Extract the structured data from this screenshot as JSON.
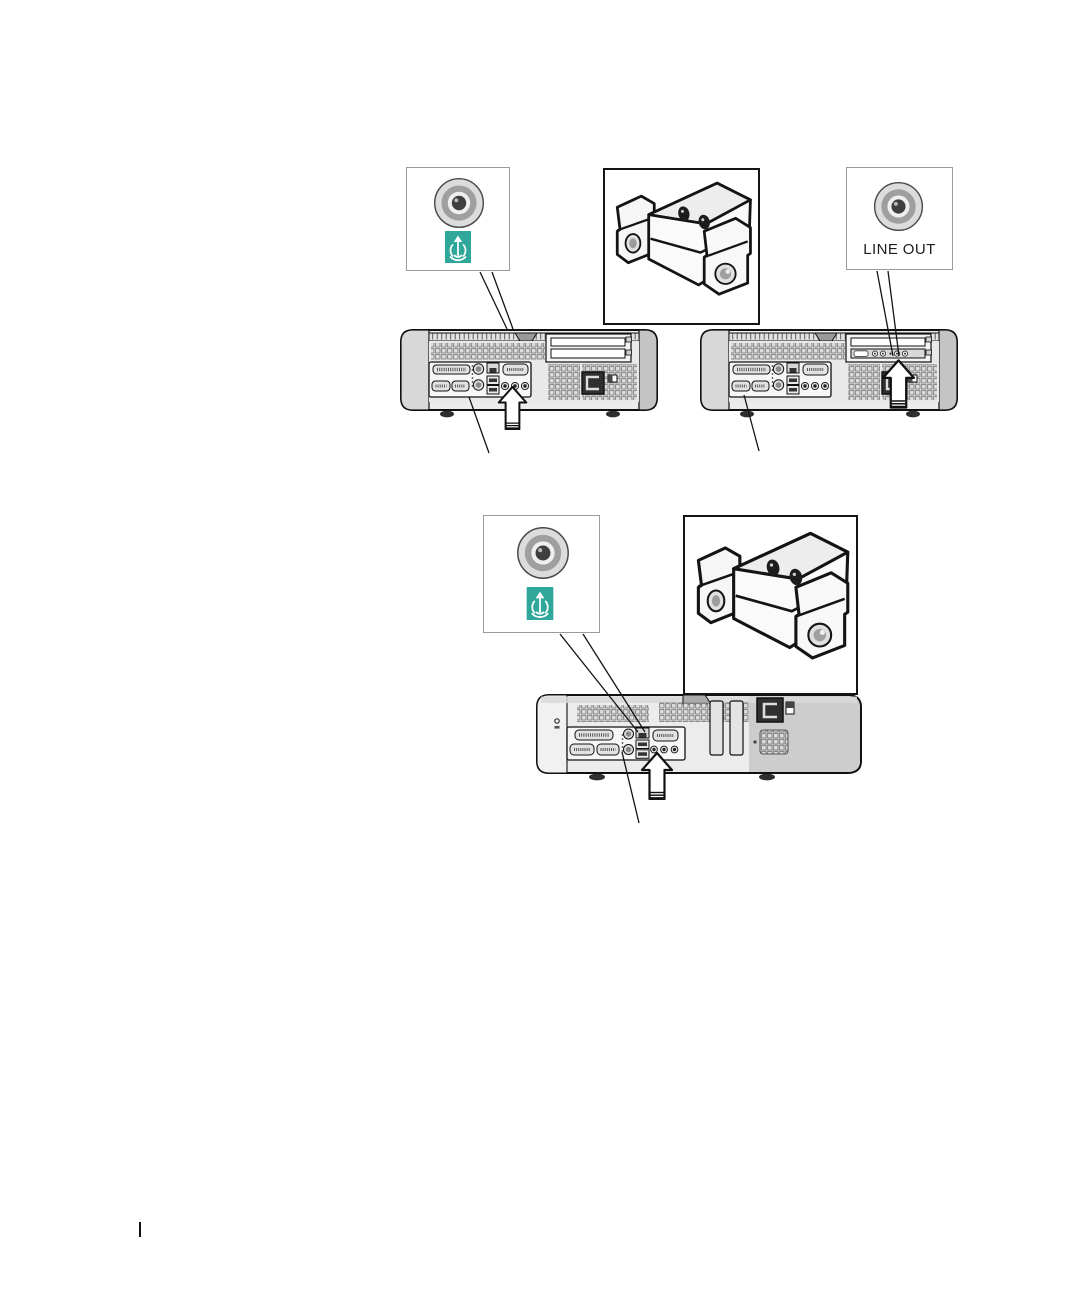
{
  "page": {
    "kind": "hardware-manual-illustration-page",
    "visible_text": [
      "LINE OUT"
    ]
  },
  "colors": {
    "teal_accent": "#2FA89B",
    "ink": "#111111",
    "callout_border": "#9b9b9b",
    "chassis_light": "#ececec",
    "chassis_mid": "#cdcdcd"
  },
  "top_figure": {
    "speaker_connector_callout": {
      "icons": [
        "audio-jack-icon",
        "speaker-line-out-symbol-icon"
      ]
    },
    "speakers_inset": {
      "icon": "desktop-speakers-illustration"
    },
    "line_out_callout": {
      "icons": [
        "audio-jack-icon"
      ],
      "label": "LINE OUT"
    },
    "computers": [
      {
        "icon": "computer-back-panel-integrated-audio",
        "pointer": "up-block-arrow-icon"
      },
      {
        "icon": "computer-back-panel-with-audio-card",
        "pointer": "up-block-arrow-icon"
      }
    ]
  },
  "bottom_figure": {
    "speaker_connector_callout": {
      "icons": [
        "audio-jack-icon",
        "speaker-line-out-symbol-icon"
      ]
    },
    "speakers_inset": {
      "icon": "desktop-speakers-illustration"
    },
    "computers": [
      {
        "icon": "computer-back-panel-integrated-audio",
        "pointer": "up-block-arrow-icon"
      }
    ]
  },
  "footer": {
    "divider_icon": "vertical-bar"
  }
}
